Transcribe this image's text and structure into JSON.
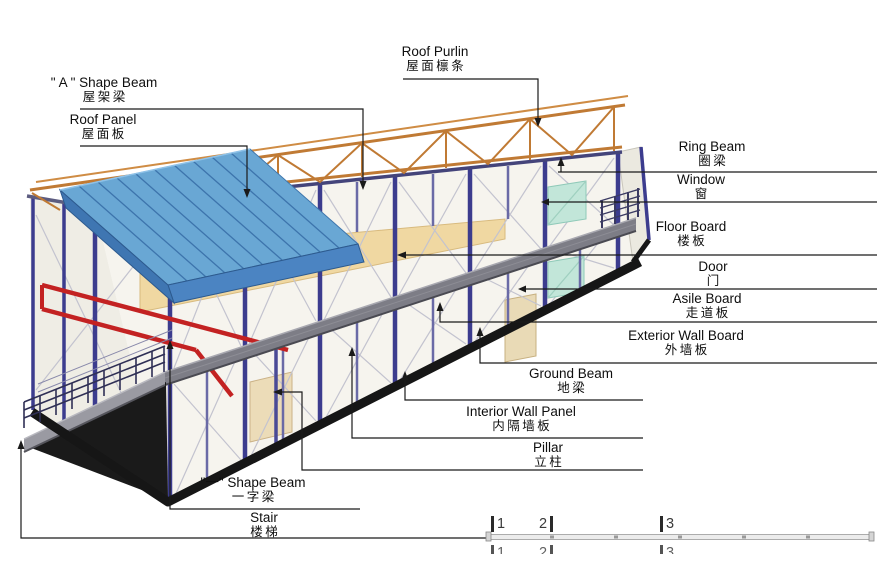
{
  "labels": {
    "a_shape_beam": {
      "en": "\" A \" Shape Beam",
      "zh": "屋架梁"
    },
    "roof_panel": {
      "en": "Roof Panel",
      "zh": "屋面板"
    },
    "roof_purlin": {
      "en": "Roof Purlin",
      "zh": "屋面檩条"
    },
    "ring_beam": {
      "en": "Ring Beam",
      "zh": "圈梁"
    },
    "window": {
      "en": "Window",
      "zh": "窗"
    },
    "floor_board": {
      "en": "Floor Board",
      "zh": "楼板"
    },
    "door": {
      "en": "Door",
      "zh": "门"
    },
    "asile_board": {
      "en": "Asile Board",
      "zh": "走道板"
    },
    "exterior_wall_board": {
      "en": "Exterior Wall Board",
      "zh": "外墙板"
    },
    "ground_beam": {
      "en": "Ground Beam",
      "zh": "地梁"
    },
    "interior_wall_panel": {
      "en": "Interior Wall Panel",
      "zh": "内隔墙板"
    },
    "pillar": {
      "en": "Pillar",
      "zh": "立柱"
    },
    "one_shape_beam": {
      "en": "\"一\" Shape Beam",
      "zh": "一字梁"
    },
    "stair": {
      "en": "Stair",
      "zh": "楼梯"
    }
  },
  "ruler": {
    "marks": [
      "1",
      "2",
      "3"
    ]
  },
  "colors": {
    "roof_panel": "#69a7d4",
    "roof_fascia": "#4b84c2",
    "truss": "#c07a34",
    "pillar": "#3c3c8e",
    "floor_board": "#f0d8a2",
    "walkway": "#7d7d86",
    "ground_beam": "#161616",
    "red_beam": "#c32222",
    "window": "#c2e6d9",
    "wall": "#f6f4ee",
    "leader": "#1a1a1a"
  }
}
